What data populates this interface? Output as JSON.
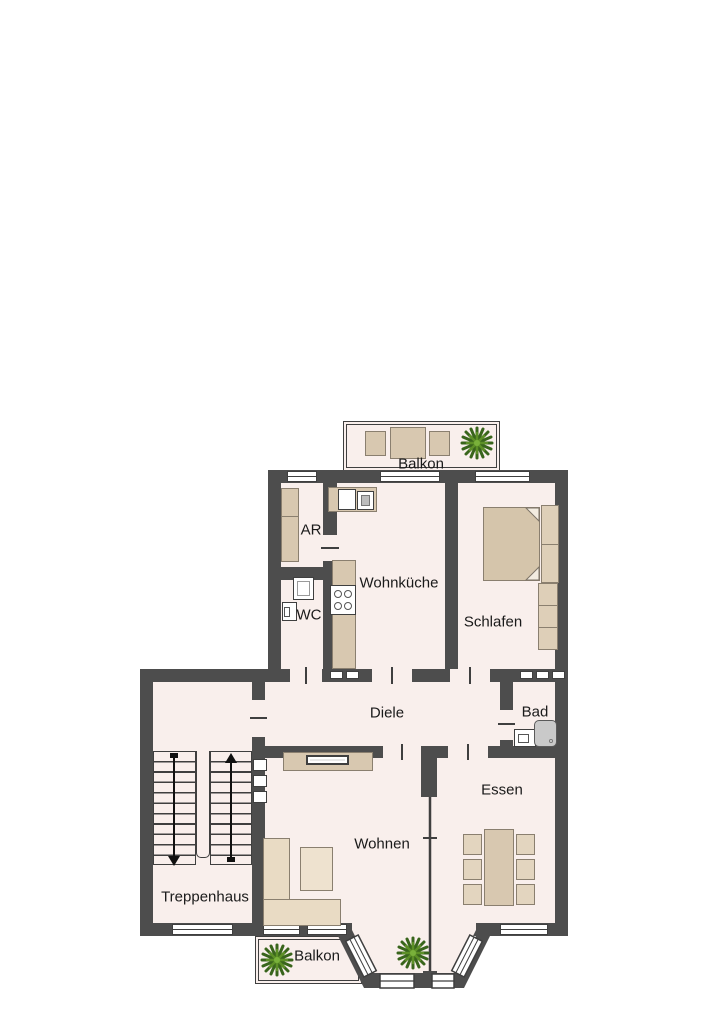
{
  "floorplan": {
    "labels": {
      "balkon_top": "Balkon",
      "ar": "AR",
      "wc": "WC",
      "wohnkueche": "Wohnküche",
      "schlafen": "Schlafen",
      "diele": "Diele",
      "bad": "Bad",
      "treppenhaus": "Treppenhaus",
      "wohnen": "Wohnen",
      "essen": "Essen",
      "balkon_bottom": "Balkon"
    },
    "colors": {
      "wall": "#4d4d4d",
      "room": "#f9efec",
      "furniture": "#d8c8b0",
      "furniture_light": "#e9dbc4",
      "window": "#ffffff",
      "shower": "#c9c9c9",
      "plant_dark": "#39651c",
      "plant_light": "#5d9027"
    }
  }
}
